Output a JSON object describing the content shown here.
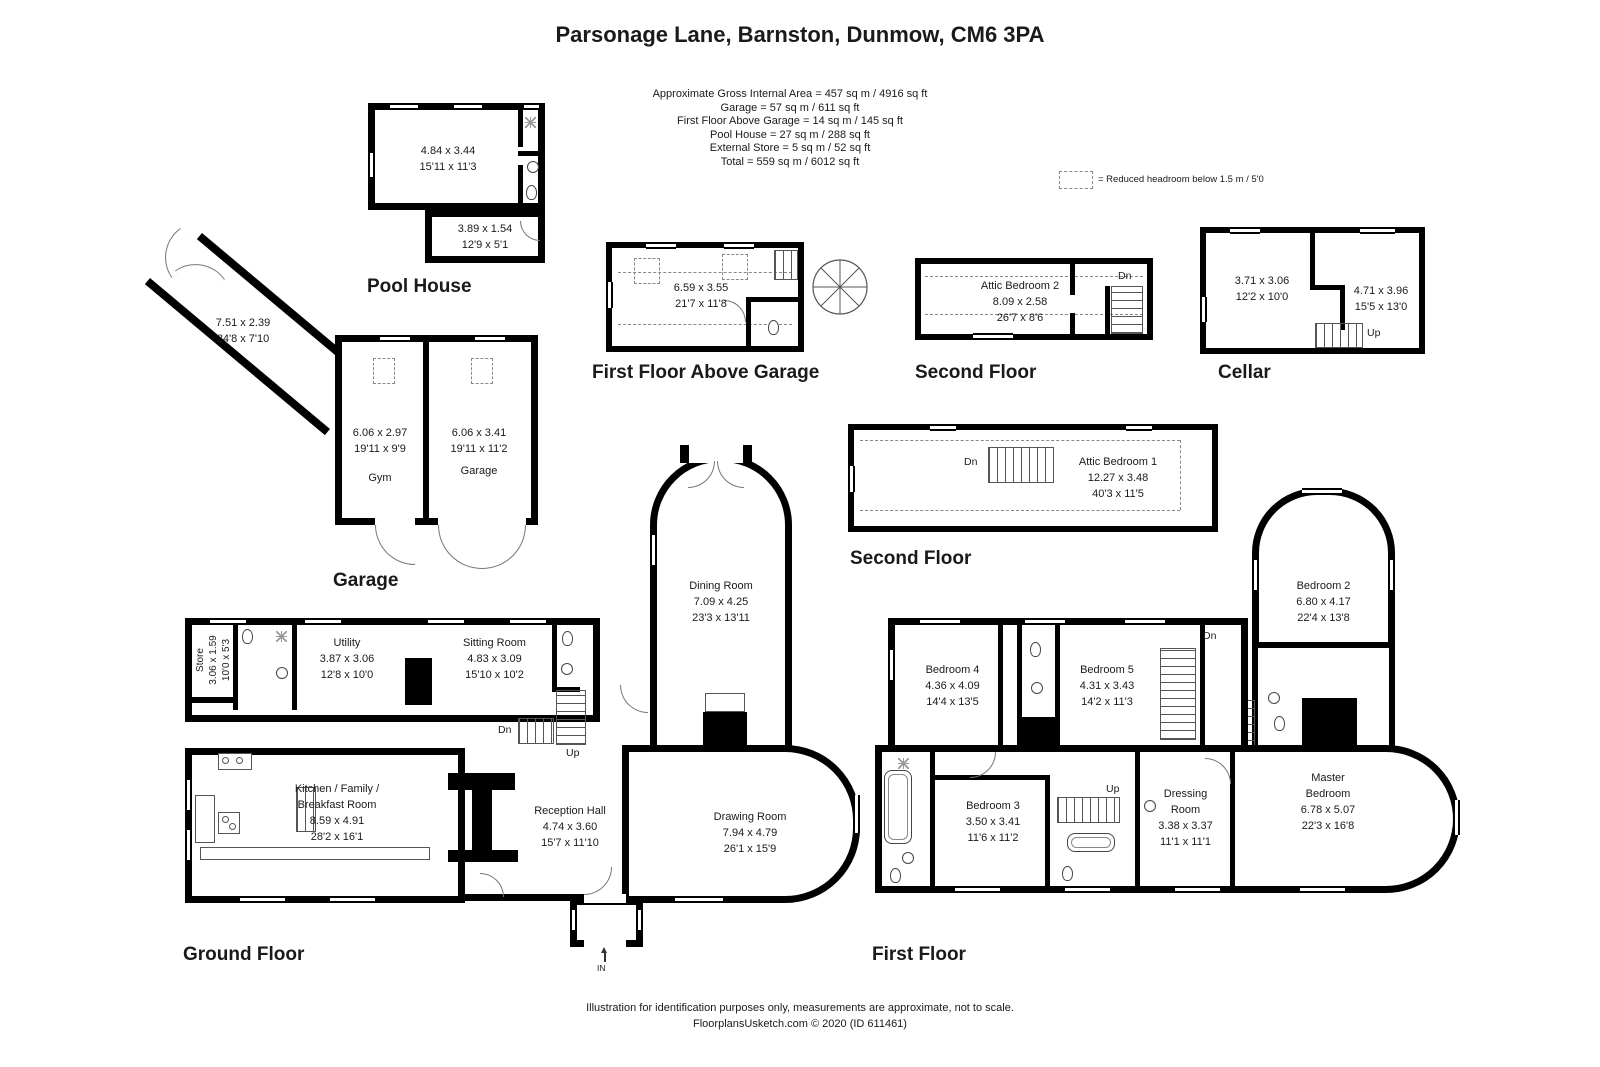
{
  "title": "Parsonage Lane, Barnston, Dunmow, CM6 3PA",
  "summary": {
    "lines": [
      "Approximate Gross Internal Area = 457 sq m / 4916 sq ft",
      "Garage = 57 sq m / 611 sq ft",
      "First Floor Above Garage  = 14 sq m / 145 sq ft",
      "Pool House = 27 sq m / 288 sq ft",
      "External Store = 5 sq m / 52 sq ft",
      "Total = 559 sq m / 6012 sq ft"
    ]
  },
  "legend": {
    "reduced_headroom": "= Reduced headroom below 1.5 m / 5'0"
  },
  "colors": {
    "walls": "#000000",
    "background": "#ffffff"
  },
  "pool_house": {
    "label": "Pool House",
    "main_room": {
      "metric": "4.84 x 3.44",
      "imperial": "15'11 x 11'3"
    },
    "store_room": {
      "metric": "3.89 x 1.54",
      "imperial": "12'9 x 5'1"
    }
  },
  "first_floor_above_garage": {
    "label": "First Floor Above Garage",
    "room": {
      "metric": "6.59 x 3.55",
      "imperial": "21'7 x 11'8"
    }
  },
  "second_floor_garage": {
    "label": "Second Floor",
    "attic_bedroom_2": {
      "name": "Attic Bedroom 2",
      "metric": "8.09 x 2.58",
      "imperial": "26'7 x 8'6"
    },
    "stairs_down": "Dn"
  },
  "cellar": {
    "label": "Cellar",
    "room_1": {
      "metric": "3.71 x 3.06",
      "imperial": "12'2 x 10'0"
    },
    "room_2": {
      "metric": "4.71 x 3.96",
      "imperial": "15'5 x 13'0"
    },
    "stairs_up": "Up"
  },
  "garage": {
    "label": "Garage",
    "corridor": {
      "metric": "7.51 x 2.39",
      "imperial": "24'8 x 7'10"
    },
    "gym": {
      "name": "Gym",
      "metric": "6.06 x 2.97",
      "imperial": "19'11 x 9'9"
    },
    "garage_room": {
      "name": "Garage",
      "metric": "6.06 x 3.41",
      "imperial": "19'11 x 11'2"
    }
  },
  "second_floor_house": {
    "label": "Second Floor",
    "attic_bedroom_1": {
      "name": "Attic Bedroom 1",
      "metric": "12.27 x 3.48",
      "imperial": "40'3 x 11'5"
    },
    "stairs_down": "Dn"
  },
  "ground_floor": {
    "label": "Ground Floor",
    "store": {
      "name": "Store",
      "metric": "3.06 x 1.59",
      "imperial": "10'0 x 5'3"
    },
    "utility": {
      "name": "Utility",
      "metric": "3.87 x 3.06",
      "imperial": "12'8 x 10'0"
    },
    "sitting_room": {
      "name": "Sitting Room",
      "metric": "4.83 x 3.09",
      "imperial": "15'10 x 10'2"
    },
    "kitchen": {
      "name_line1": "Kitchen / Family /",
      "name_line2": "Breakfast Room",
      "metric": "8.59 x 4.91",
      "imperial": "28'2 x 16'1"
    },
    "reception_hall": {
      "name": "Reception Hall",
      "metric": "4.74 x 3.60",
      "imperial": "15'7 x 11'10"
    },
    "dining_room": {
      "name": "Dining Room",
      "metric": "7.09 x 4.25",
      "imperial": "23'3 x 13'11"
    },
    "drawing_room": {
      "name": "Drawing Room",
      "metric": "7.94 x 4.79",
      "imperial": "26'1 x 15'9"
    },
    "stairs_down": "Dn",
    "stairs_up": "Up",
    "entrance": "IN"
  },
  "first_floor": {
    "label": "First Floor",
    "bedroom_2": {
      "name": "Bedroom 2",
      "metric": "6.80 x 4.17",
      "imperial": "22'4 x 13'8"
    },
    "bedroom_4": {
      "name": "Bedroom 4",
      "metric": "4.36 x 4.09",
      "imperial": "14'4 x 13'5"
    },
    "bedroom_5": {
      "name": "Bedroom 5",
      "metric": "4.31 x 3.43",
      "imperial": "14'2 x 11'3"
    },
    "bedroom_3": {
      "name": "Bedroom 3",
      "metric": "3.50 x 3.41",
      "imperial": "11'6 x 11'2"
    },
    "dressing_room": {
      "name_line1": "Dressing",
      "name_line2": "Room",
      "metric": "3.38 x 3.37",
      "imperial": "11'1 x 11'1"
    },
    "master_bedroom": {
      "name_line1": "Master",
      "name_line2": "Bedroom",
      "metric": "6.78 x 5.07",
      "imperial": "22'3 x 16'8"
    },
    "stairs_down": "Dn",
    "stairs_up_bathroom": "Up",
    "stairs_up_master": "Up"
  },
  "footer": {
    "line1": "Illustration for identification purposes only, measurements are approximate, not to scale.",
    "line2": "FloorplansUsketch.com © 2020 (ID 611461)"
  }
}
